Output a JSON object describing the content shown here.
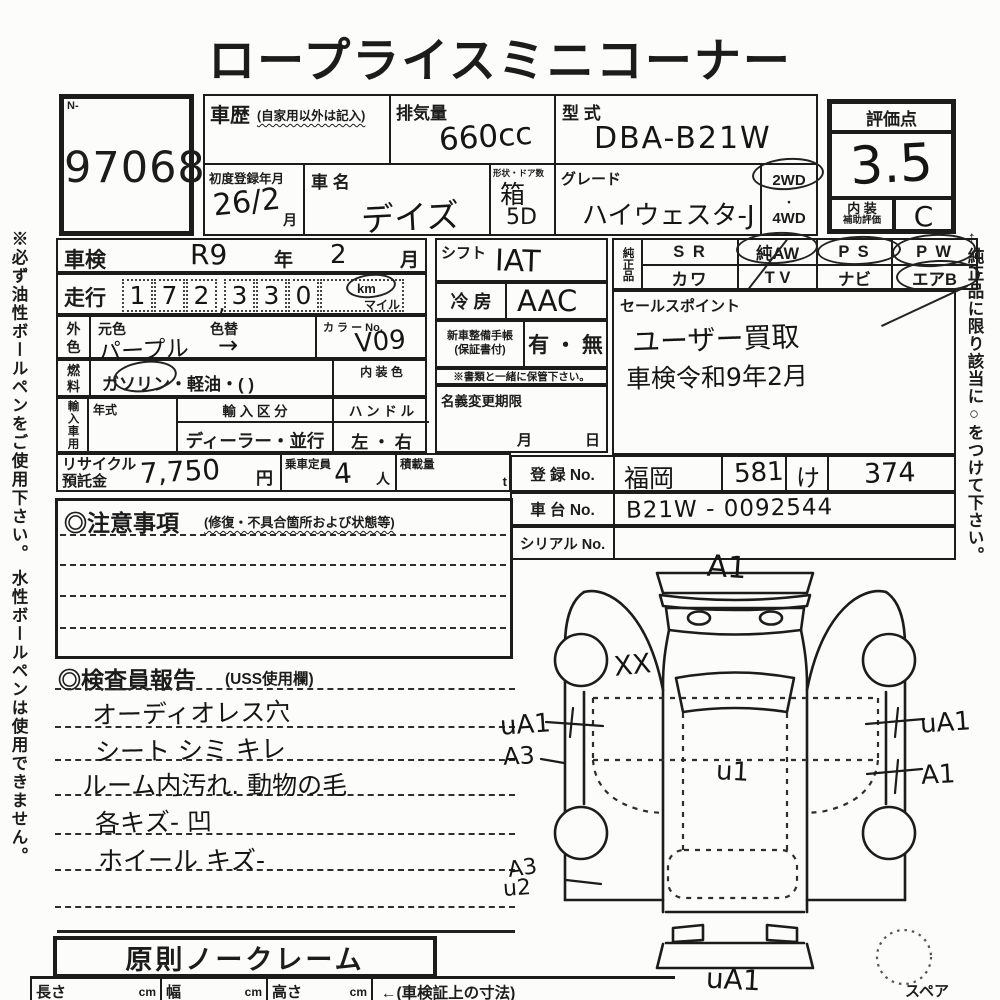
{
  "title": "ロープライスミニコーナー",
  "lot": {
    "prefix": "N-",
    "number": "97068"
  },
  "top": {
    "history_label": "車歴",
    "history_note": "(自家用以外は記入)",
    "disp_label": "排気量",
    "disp_value": "660cc",
    "model_label": "型 式",
    "model_value": "DBA-B21W",
    "firstreg_label": "初度登録年月",
    "firstreg_value": "26/2",
    "firstreg_unit": "月",
    "name_label": "車 名",
    "name_value": "デイズ",
    "shape_label": "形状・ドア数",
    "shape_value": "箱",
    "shape_doors": "5D",
    "grade_label": "グレード",
    "grade_value": "ハイウェスタ-J",
    "wd2": "2WD",
    "wd_dot": "・",
    "wd4": "4WD"
  },
  "score": {
    "label": "評価点",
    "value": "3.5",
    "interior_line1": "内 装",
    "interior_line2": "補助評価",
    "interior_value": "C"
  },
  "left": {
    "shaken_label": "車検",
    "shaken_era": "R9",
    "shaken_year": "年",
    "shaken_m": "2",
    "shaken_month": "月",
    "mileage_label": "走行",
    "digits": [
      "1",
      "7",
      "2",
      "3",
      "3",
      "0"
    ],
    "comma": ",",
    "km": "km",
    "mile": "マイル",
    "color_label1": "外",
    "color_label2": "色",
    "base_label": "元色",
    "base_value": "パープル",
    "change_label": "色替",
    "change_value": "→",
    "colorno_label": "カ ラ ー No.",
    "colorno_value": "V09",
    "fuel_label1": "燃",
    "fuel_label2": "料",
    "fuel_options": "ガソリン・軽油・(            )",
    "intcolor_label": "内 装 色",
    "import_label": "輸入車用",
    "year_label": "年式",
    "division_label": "輸 入 区 分",
    "division_value": "ディーラー・並行",
    "handle_label": "ハ ン ド ル",
    "handle_value": "左 ・ 右",
    "recycle_label1": "リサイクル",
    "recycle_label2": "預託金",
    "recycle_value": "7,750",
    "recycle_unit": "円",
    "pax_label": "乗車定員",
    "pax_value": "4",
    "pax_unit": "人",
    "load_label": "積載量",
    "load_unit": "t"
  },
  "mid": {
    "shift_label": "シフト",
    "shift_value": "IAT",
    "ac_label": "冷 房",
    "ac_value": "AAC",
    "book_label1": "新車整備手帳",
    "book_label2": "(保証書付)",
    "book_options": "有 ・ 無",
    "book_note": "※書類と一緒に保管下さい。",
    "transfer_label": "名義変更期限",
    "transfer_month": "月",
    "transfer_day": "日"
  },
  "genuine": {
    "label": "純正品",
    "row1": [
      "S R",
      "純AW",
      "P S",
      "P W"
    ],
    "row2": [
      "カワ",
      "T V",
      "ナビ",
      "エアB"
    ]
  },
  "sales": {
    "label": "セールスポイント",
    "line1": "ユーザー買取",
    "line2": "車検令和9年2月"
  },
  "reg": {
    "reg_label": "登 録 No.",
    "area": "福岡",
    "class_no": "581",
    "kana": "け",
    "number": "374",
    "chassis_label": "車 台 No.",
    "chassis_value": "B21W - 0092544",
    "serial_label": "シリアル No."
  },
  "caution": {
    "label": "◎注意事項",
    "note": "(修復・不具合箇所および状態等)"
  },
  "inspector": {
    "label": "◎検査員報告",
    "note": "(USS使用欄)",
    "lines": [
      "オーディオレス穴",
      "シート シミ キレ",
      "ルーム内汚れ. 動物の毛",
      "各キズ- 凹",
      "ホイール キズ-"
    ]
  },
  "diagram": {
    "front": "A1",
    "xx": "XX",
    "left_upper": "uA1",
    "left_mid": "A3",
    "roof": "u1",
    "right_upper": "uA1",
    "right_mid": "A1",
    "left_lower1": "A3",
    "left_lower2": "u2",
    "rear": "uA1",
    "spare": "スペア"
  },
  "bottom": {
    "noclaim": "原則ノークレーム",
    "length_label": "長さ",
    "width_label": "幅",
    "height_label": "高さ",
    "cm": "cm",
    "note": "←(車検証上の寸法)"
  },
  "sides": {
    "left": "※必ず油性ボールペンをご使用下さい。 水性ボールペンは使用できません。",
    "right": "←純正品に限り該当に○をつけて下さい。"
  }
}
